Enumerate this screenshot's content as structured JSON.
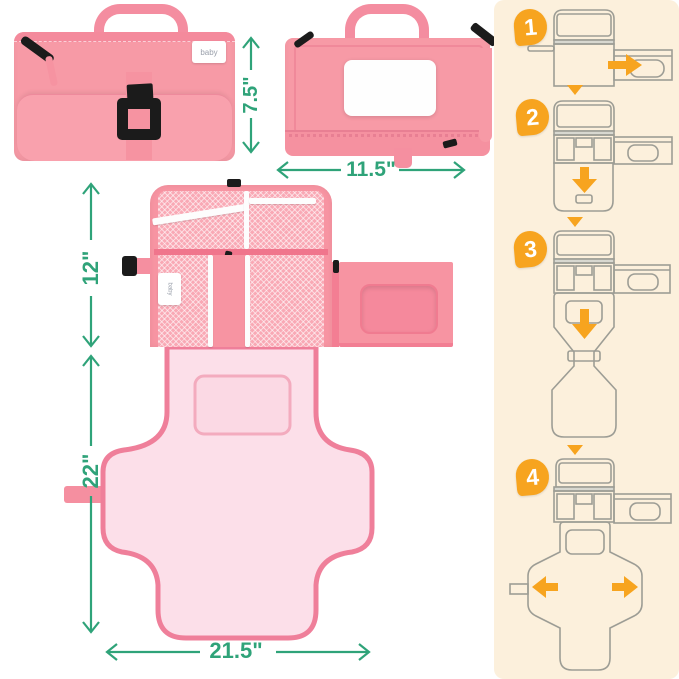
{
  "product": {
    "brand_logo": "baby"
  },
  "dimensions": {
    "folded_height_label": "7.5\"",
    "folded_width_label": "11.5\"",
    "open_top_height_label": "12\"",
    "mat_height_label": "22\"",
    "mat_width_label": "21.5\""
  },
  "instructions": {
    "steps": [
      {
        "number": "1"
      },
      {
        "number": "2"
      },
      {
        "number": "3"
      },
      {
        "number": "4"
      }
    ]
  },
  "colors": {
    "dimension_green": "#2fa379",
    "step_orange": "#f7a41f",
    "panel_cream": "#fcf0dc",
    "bag_pink": "#f79aa6",
    "mat_pink_light": "#fcdfe9",
    "mat_pink_border": "#ef7f9a",
    "buckle_black": "#1b1b1b"
  }
}
